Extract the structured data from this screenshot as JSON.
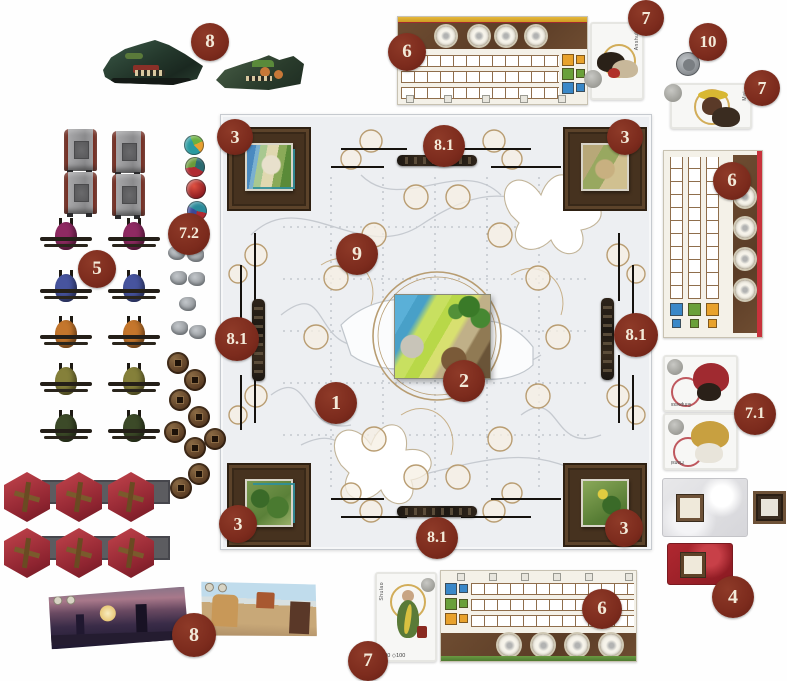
{
  "diagram_type": "board-game-setup-diagram",
  "callouts": {
    "boats_top": "8",
    "board_top": "6",
    "card_tr1": "7",
    "start_token": "10",
    "card_tr2": "7",
    "corner_tl": "3",
    "edge_top": "8.1",
    "corner_tr": "3",
    "board_right": "6",
    "round_tokens": "7.2",
    "boat_meeples": "5",
    "board_region": "9",
    "edge_left": "8.1",
    "edge_right": "8.1",
    "main_board": "1",
    "center_tile": "2",
    "cards_right": "7.1",
    "corner_bl": "3",
    "edge_bottom": "8.1",
    "corner_br": "3",
    "red_deck": "4",
    "screens": "8",
    "card_bottom": "7",
    "board_bottom": "6"
  },
  "cards": {
    "top_right_first": {
      "name": "Anshul"
    },
    "top_right_second": {
      "name": "Mai"
    },
    "right_upper": {
      "name": "Empress"
    },
    "right_lower": {
      "name": "Hansi"
    },
    "bottom": {
      "name": "Shulao",
      "footer": "◇20  ◇100"
    }
  },
  "colors": {
    "callout_bg": "#7c2b1d",
    "callout_text": "#f3ead9",
    "board_bg": "#edeff2",
    "board_line": "#c6cad0",
    "spot_ring": "#b99d72",
    "corner_wood": "#46321f",
    "band_brown": "#6e4c31",
    "gold_bar": "#d9a92f",
    "red_strip": "#c8323c",
    "green_strip": "#5a8a3a",
    "square_blue": "#3a88c8",
    "square_green": "#6aa03a",
    "square_orange": "#e8a22c",
    "hex_red": "#a8323a",
    "coin_brown": "#6b4a2a",
    "meeple_colors": [
      "#8e2a62",
      "#47549e",
      "#c4762c",
      "#85803a",
      "#3c4a28"
    ]
  },
  "components": {
    "dragon_boats": {
      "count": 2
    },
    "player_boards": {
      "count": 3
    },
    "bridges": {
      "count": 4
    },
    "round_tokens": {
      "count": 4
    },
    "boat_meeples": {
      "count": 10,
      "rows": 5,
      "columns": 2
    },
    "cargo_bags": {
      "count": 7
    },
    "coins": {
      "count": 9
    },
    "pavilion_tiles": {
      "count": 6
    },
    "player_screens": {
      "count": 2
    },
    "corner_landscape_tiles": {
      "count": 4
    },
    "center_tile": {
      "count": 1
    },
    "edge_boats": {
      "count": 4
    },
    "gray_deck": {
      "count": 1
    },
    "red_deck": {
      "count": 1
    },
    "character_cards": {
      "count": 5
    },
    "start_player_token": {
      "count": 1
    }
  }
}
